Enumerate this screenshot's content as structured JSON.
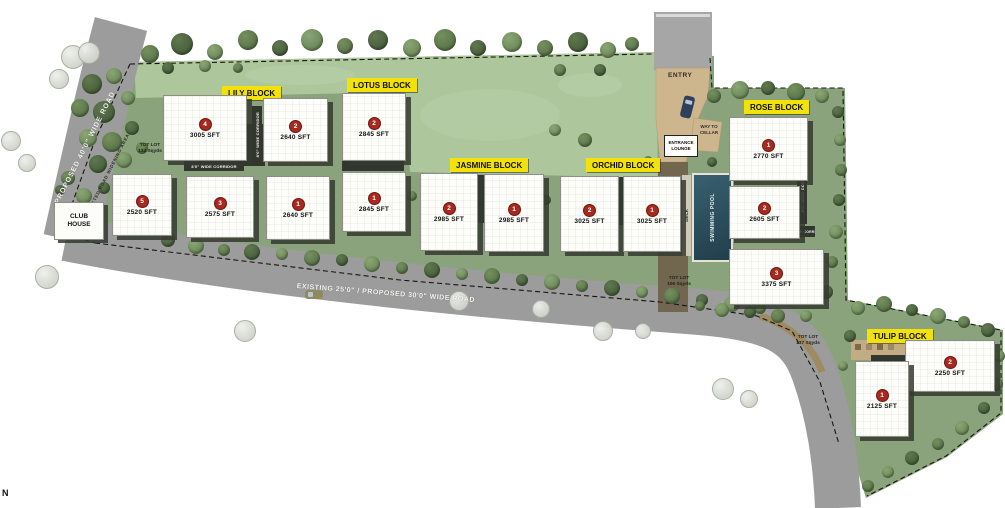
{
  "plan": {
    "north_label": "N",
    "entry_label": "ENTRY",
    "roads": {
      "proposed": "PROPOSED 40'0\" WIDE ROAD",
      "widening": "AFFECTED ROAD WIDENING AREA",
      "existing": "EXISTING 25'0\" / PROPOSED 30'0\" WIDE ROAD"
    },
    "amenities": {
      "club_house": "CLUB HOUSE",
      "entrance_lounge": "ENTRANCE LOUNGE",
      "way_to_cellar": "WAY TO CELLAR",
      "swimming_pool": "SWIMMING POOL",
      "deck": "DECK"
    },
    "corridors": {
      "wide8": "8'0\" WIDE CORRIDOR",
      "wide10": "10'0\" WIDE CORRIDOR"
    },
    "tot_lots": [
      {
        "label": "TOT LOT",
        "area": "134 Sqyds"
      },
      {
        "label": "TOT LOT",
        "area": "106 Sqyds"
      },
      {
        "label": "TOT LOT",
        "area": "137 Sqyds"
      }
    ]
  },
  "blocks": [
    {
      "name": "LILY BLOCK",
      "units": [
        {
          "no": "4",
          "area": "3005 SFT"
        },
        {
          "no": "2",
          "area": "2640 SFT"
        },
        {
          "no": "5",
          "area": "2520 SFT"
        },
        {
          "no": "3",
          "area": "2575 SFT"
        },
        {
          "no": "1",
          "area": "2640 SFT"
        }
      ]
    },
    {
      "name": "LOTUS BLOCK",
      "units": [
        {
          "no": "2",
          "area": "2845 SFT"
        },
        {
          "no": "1",
          "area": "2845 SFT"
        }
      ]
    },
    {
      "name": "JASMINE BLOCK",
      "units": [
        {
          "no": "2",
          "area": "2985 SFT"
        },
        {
          "no": "1",
          "area": "2985 SFT"
        }
      ]
    },
    {
      "name": "ORCHID BLOCK",
      "units": [
        {
          "no": "2",
          "area": "3025 SFT"
        },
        {
          "no": "1",
          "area": "3025 SFT"
        }
      ]
    },
    {
      "name": "ROSE BLOCK",
      "units": [
        {
          "no": "1",
          "area": "2770 SFT"
        },
        {
          "no": "2",
          "area": "2605 SFT"
        },
        {
          "no": "3",
          "area": "3375 SFT"
        }
      ]
    },
    {
      "name": "TULIP BLOCK",
      "units": [
        {
          "no": "2",
          "area": "2250 SFT"
        },
        {
          "no": "1",
          "area": "2125 SFT"
        }
      ]
    }
  ],
  "colors": {
    "block_label_bg": "#f2e20a",
    "unit_badge": "#a8291f",
    "site_green": "#8ba37c",
    "lawn_green": "#adc69c",
    "road_gray": "#9c9c9c",
    "pool_blue": "#2b4f5e"
  }
}
